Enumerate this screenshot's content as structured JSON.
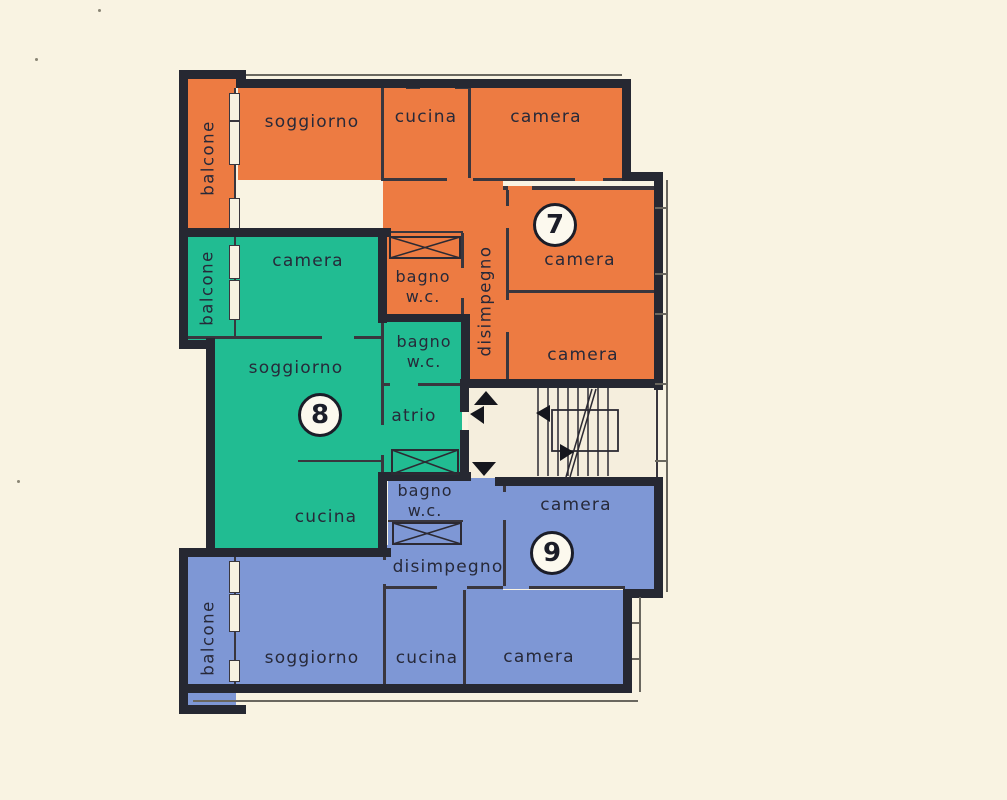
{
  "plan": {
    "type": "apartment-floor-plan",
    "labels": {
      "soggiorno": "soggiorno",
      "cucina": "cucina",
      "camera": "camera",
      "balcone": "balcone",
      "bagno": "bagno",
      "wc": "w.c.",
      "disimpegno": "disimpegno",
      "atrio": "atrio"
    },
    "apartments": {
      "apt7": {
        "number": "7",
        "color": "#ed7b42",
        "rooms": [
          "balcone",
          "soggiorno",
          "cucina",
          "camera",
          "bagno w.c.",
          "disimpegno",
          "camera",
          "camera"
        ]
      },
      "apt8": {
        "number": "8",
        "color": "#21bc92",
        "rooms": [
          "balcone",
          "camera",
          "soggiorno",
          "bagno w.c.",
          "atrio",
          "cucina"
        ]
      },
      "apt9": {
        "number": "9",
        "color": "#7e97d5",
        "rooms": [
          "bagno w.c.",
          "disimpegno",
          "camera",
          "balcone",
          "soggiorno",
          "cucina",
          "camera"
        ]
      }
    },
    "stairwell": {
      "feature": "staircase",
      "icons": [
        "up-arrow",
        "left-arrow",
        "down-arrow",
        "left-arrow",
        "right-arrow"
      ]
    },
    "colors": {
      "paper": "#f9f3e2",
      "walls": "#262832",
      "apt7": "#ed7b42",
      "apt8": "#21bc92",
      "apt9": "#7e97d5",
      "stairwell": "#f5eedd"
    }
  }
}
